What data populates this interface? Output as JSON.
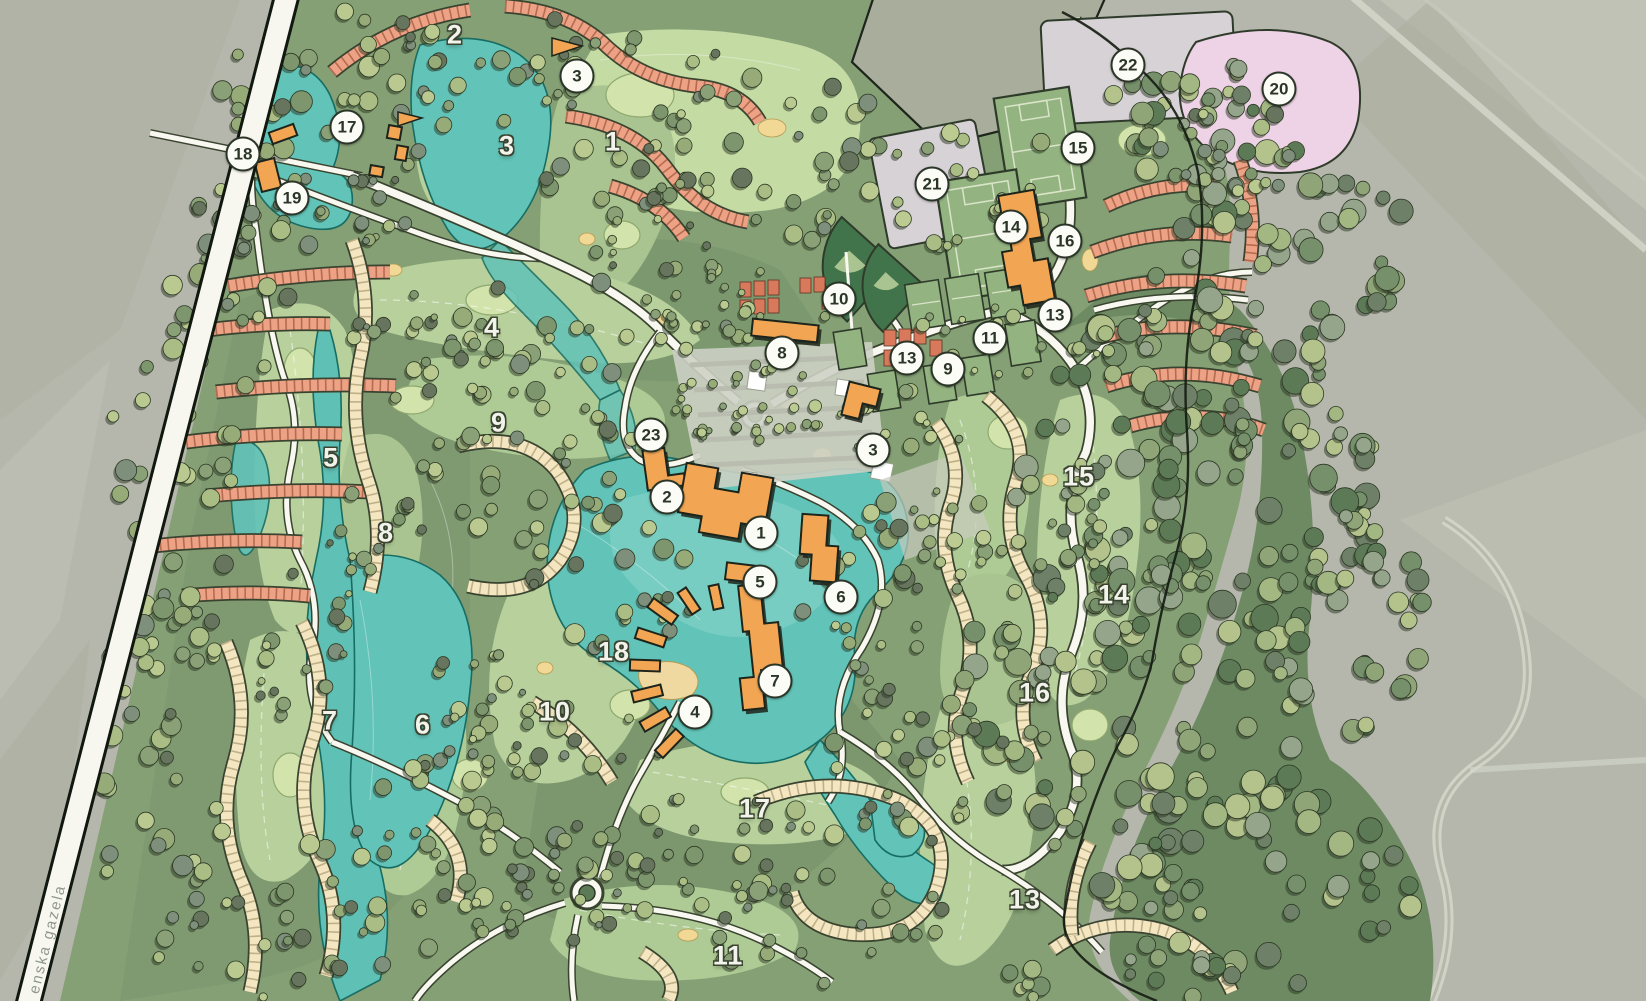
{
  "map": {
    "kind": "illustrated resort / golf community master plan over aerial farmland",
    "road_label": "enska gazela",
    "markers_circled": [
      {
        "label": "3"
      },
      {
        "label": "17"
      },
      {
        "label": "18"
      },
      {
        "label": "19"
      },
      {
        "label": "22"
      },
      {
        "label": "20"
      },
      {
        "label": "21"
      },
      {
        "label": "15"
      },
      {
        "label": "14"
      },
      {
        "label": "16"
      },
      {
        "label": "10"
      },
      {
        "label": "13"
      },
      {
        "label": "11"
      },
      {
        "label": "13"
      },
      {
        "label": "9"
      },
      {
        "label": "8"
      },
      {
        "label": "23"
      },
      {
        "label": "3"
      },
      {
        "label": "2"
      },
      {
        "label": "1"
      },
      {
        "label": "5"
      },
      {
        "label": "6"
      },
      {
        "label": "7"
      },
      {
        "label": "4"
      }
    ],
    "hole_numbers": [
      {
        "label": "2"
      },
      {
        "label": "3"
      },
      {
        "label": "1"
      },
      {
        "label": "4"
      },
      {
        "label": "9"
      },
      {
        "label": "5"
      },
      {
        "label": "8"
      },
      {
        "label": "18"
      },
      {
        "label": "10"
      },
      {
        "label": "7"
      },
      {
        "label": "6"
      },
      {
        "label": "17"
      },
      {
        "label": "11"
      },
      {
        "label": "13"
      },
      {
        "label": "15"
      },
      {
        "label": "14"
      },
      {
        "label": "16"
      }
    ],
    "palette": {
      "farmland_gray": "#b5b7ac",
      "site_green": "#85a075",
      "rough_green": "#6d8a62",
      "fairway_green": "#b7d09c",
      "putting_green": "#d2e3ab",
      "water_teal": "#62c3b8",
      "road_white": "#f8f8f0",
      "housing_salmon": "#eda285",
      "housing_cream": "#f3e6c0",
      "building_orange": "#f2a654",
      "pad_gray": "#d7d2d5",
      "pad_pink": "#eed2e5",
      "sports_field_green": "#93b381",
      "outline_dark": "#2b3527",
      "sand_bunker": "#f1d894"
    }
  }
}
